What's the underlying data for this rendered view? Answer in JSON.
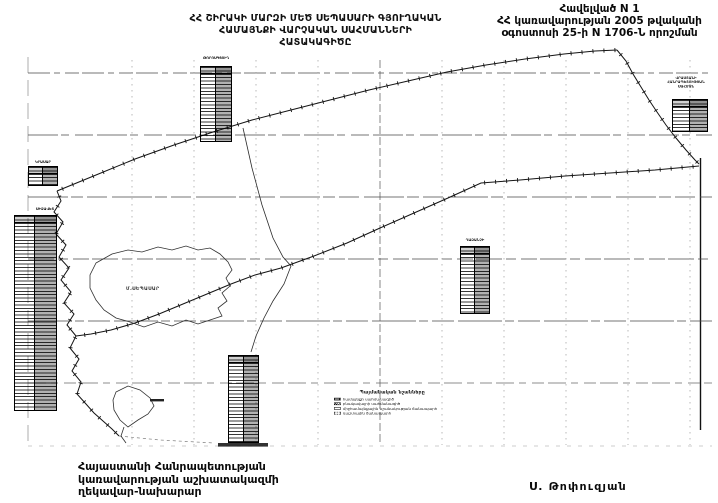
{
  "annex": {
    "line1": "Հավելված N 1",
    "line2": "ՀՀ կառավարության 2005 թվականի",
    "line3": "օգոստոսի 25-ի N 1706-Ն որոշման"
  },
  "title": {
    "line1": "ՀՀ ՇԻՐԱԿԻ ՄԱՐԶԻ ՄԵԾ ՍԵՊԱՍԱՐԻ ԳՅՈՒՂԱԿԱՆ",
    "line2": "ՀԱՄԱՅՆՔԻ ՎԱՐՉԱԿԱՆ ՍԱՀՄԱՆՆԵՐԻ",
    "line3": "ՀԱՏԱԿԱԳԻԾԸ"
  },
  "footer": {
    "line1": "Հայաստանի Հանրապետության",
    "line2": "կառավարության աշխատակազմի",
    "line3": "ղեկավար-նախարար",
    "signature": "Ս. Թոփուզյան"
  },
  "legend": {
    "title": "Պայմանական նշանները",
    "items": [
      {
        "label": "համայնքի սահմանագիծ"
      },
      {
        "label": "բնակավայրի սահմանագիծ"
      },
      {
        "label": "միջհամայնքային նշանակության ճանապարհ"
      },
      {
        "label": "դաշտային ճանապարհ"
      }
    ]
  },
  "map": {
    "settlement_label": "Մ.ՍԵՊԱՍԱՐ",
    "table_labels": {
      "t1": "ԹՈՐՈՍԳՅՈՒՂ",
      "t2": "ԿՐԱՍԱՐ",
      "t3": "ՍԻԶԱՎԵՏ",
      "t5": "ՂԱԶԱՆՉԻ"
    },
    "border_note": {
      "line1": "ՎՐԱՍՏԱՆԻ",
      "line2": "ՀԱՆՐԱՊԵՏՈՒԹՅԱՆ",
      "line3": "ՍԱՀՄԱՆ"
    }
  }
}
